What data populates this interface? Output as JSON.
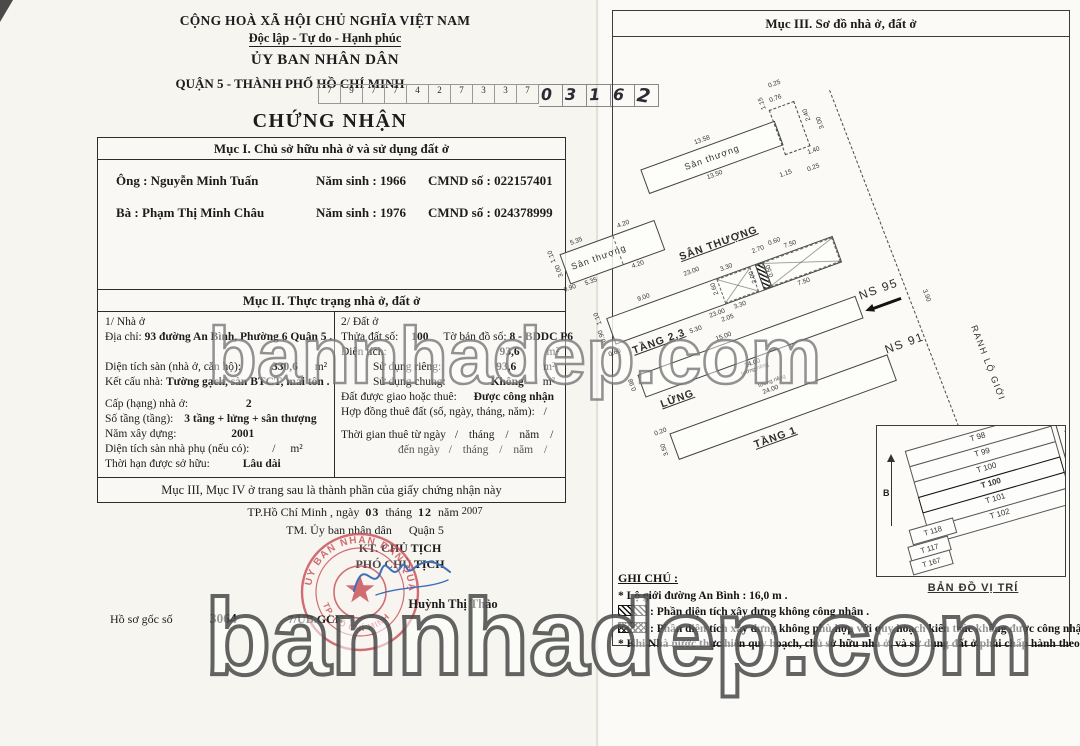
{
  "colors": {
    "seal_red": "#c94f58",
    "signature_blue": "#3f6fb8",
    "paper": "#f6f5f0"
  },
  "watermark": {
    "middle": "bannhadep.com",
    "bottom": "bannhadep.com"
  },
  "left_page": {
    "header": {
      "national_title": "CỘNG HOÀ XÃ HỘI CHỦ NGHĨA VIỆT NAM",
      "motto": "Độc lập - Tự do - Hạnh phúc",
      "issuer": "ỦY BAN NHÂN DÂN",
      "issuer_district": "QUẬN 5 - THÀNH PHỐ HỒ CHÍ MINH",
      "serial_printed": [
        "7",
        "9",
        "7",
        "7",
        "4",
        "2",
        "7",
        "3",
        "3",
        "7"
      ],
      "serial_handwritten": [
        "0",
        "3",
        "1",
        "6",
        "2"
      ],
      "doc_title": "CHỨNG NHẬN"
    },
    "section1": {
      "title": "Mục I. Chủ sở hữu nhà ở và sử dụng đất ở",
      "owner1": {
        "role": "Ông : ",
        "name": "Nguyễn Minh Tuấn",
        "birth_label": "Năm sinh : ",
        "birth": "1966",
        "id_label": "CMND số : ",
        "id": "022157401"
      },
      "owner2": {
        "role": "Bà   : ",
        "name": "Phạm Thị Minh Châu",
        "birth_label": "Năm sinh : ",
        "birth": "1976",
        "id_label": "CMND số : ",
        "id": "024378999"
      }
    },
    "section2": {
      "title": "Mục II. Thực trạng nhà ở, đất ở",
      "house": {
        "heading": "1/ Nhà ở",
        "addr_label": "Địa chỉ:",
        "addr": "93 đường An Bình, Phường 6 Quận 5 .",
        "floor_area_label": "Diện tích sàn (nhà ở, căn hộ):",
        "floor_area": "330,6",
        "unit": "m²",
        "structure_label": "Kết cấu nhà:",
        "structure": "Tường gạch, sàn BTCT, mái tôn .",
        "grade_label": "Cấp (hạng) nhà ở:",
        "grade": "2",
        "storeys_label": "Số tầng (tầng):",
        "storeys": "3 tầng + lửng + sân thượng",
        "year_label": "Năm xây dựng:",
        "year": "2001",
        "aux_label": "Diện tích sàn nhà phụ (nếu có):",
        "aux": "/",
        "aux_unit": "m²",
        "tenure_label": "Thời hạn được sở hữu:",
        "tenure": "Lâu dài"
      },
      "land": {
        "heading": "2/ Đất ở",
        "parcel_label": "Thửa đất số:",
        "parcel": "100",
        "mapsheet_label": "Tờ bản đồ số:",
        "mapsheet": "8 - BDDC P6",
        "area_label": "Diện tích:",
        "area": "93,6",
        "unit": "m²",
        "private_label": "Sử dụng riêng:",
        "private": "93,6",
        "shared_label": "Sử dụng chung:",
        "shared": "Không",
        "granted_label": "Đất được giao hoặc thuê:",
        "granted": "Được công nhận",
        "lease_label": "Hợp đồng thuê đất (số, ngày, tháng, năm):",
        "lease": "/",
        "lease_from": "Thời gian thuê từ ngày",
        "lease_to": "đến ngày",
        "slash": "/",
        "month": "tháng",
        "yearw": "năm"
      },
      "footer": "Mục III, Mục IV ở trang sau là thành phần của giấy chứng nhận này"
    },
    "signing": {
      "place": "TP.Hồ Chí Minh",
      "comma_day": ", ngày",
      "day": "03",
      "month_label": "tháng",
      "month": "12",
      "year_label": "năm",
      "year": "2007",
      "onbehalf": "TM. Ủy ban nhân dân",
      "district": "Quận 5",
      "kt": "KT. CHỦ TỊCH",
      "deputy": "PHÓ CHỦ TỊCH",
      "signer": "Huỳnh Thị Thảo",
      "seal_top": "ỦY BAN NHÂN DÂN QUẬN 5",
      "seal_bottom": "TP. HỒ CHÍ MINH",
      "file_label": "Hồ sơ gốc số",
      "file_no": "3064",
      "file_suffix": "7/UB.GCN"
    }
  },
  "right_page": {
    "title": "Mục III. Sơ đồ nhà ở, đất ở",
    "plan": {
      "terrace_main": {
        "label": "Sân thượng",
        "dim_top": "13.58",
        "dim_bottom": "13.50"
      },
      "annex": {
        "d1": "1.15",
        "d2": "0.76",
        "d3": "2.40",
        "d4": "0.25",
        "d5": "1.40",
        "d6": "3.00",
        "d7": "1.15",
        "d8": "0.25"
      },
      "terrace_small": {
        "label": "Sân thượng",
        "dim_top1": "5.35",
        "dim_top2": "4.20",
        "dim_bottom1": "4.20",
        "dim_bottom2": "5.35",
        "dim_l1": "1.10",
        "dim_l2": "3.00",
        "dim_l3": "0.90"
      },
      "terrace_title": "SÂN THƯỢNG",
      "floor23": {
        "label": "TẦNG 2,3",
        "dim_top": "23.00",
        "dim_bottom": "23.00",
        "dim_seg": "9.00",
        "x1_top": "3.30",
        "x1_left": "2.60",
        "x1_right": "2.00",
        "x1_bottom": "3.30",
        "d_530": "5.30",
        "d_205": "2.05",
        "d_270": "2.70",
        "d_060": "0.60",
        "d_050": "0.50",
        "x2_top": "7.50",
        "x2_bottom": "7.50",
        "dim_l1": "1.10",
        "dim_l2": "0.90",
        "dim_l3": "0.60"
      },
      "mezzanine": {
        "label": "LỬNG",
        "dim_top": "15.00",
        "dim_bottom": "24.00",
        "wall_note": "tường riêng",
        "dim_l1": "0.98"
      },
      "floor1": {
        "label": "TẦNG 1",
        "dim_top": "24.00",
        "wall_note": "tường riêng",
        "dim_l1": "0.20",
        "dim_l2": "3.50"
      },
      "neighbor_top": "NS 95",
      "neighbor_bottom": "NS 91",
      "boundary_label": "RANH LỘ GIỚI",
      "boundary_dim": "3.90"
    },
    "minimap": {
      "parcels": [
        "T 98",
        "T 99",
        "T 100",
        "T 100",
        "T 101",
        "T 102"
      ],
      "parcels_left": [
        "T 118",
        "T 117",
        "T 167"
      ],
      "street": "ĐƯỜNG AN BÌNH",
      "street_width": "16m",
      "direction": "Đi Hàm Tử",
      "north": "B",
      "title": "BẢN ĐỒ VỊ TRÍ"
    },
    "notes": {
      "title": "GHI CHÚ :",
      "item1": "* Lộ giới đường An Bình : 16,0 m .",
      "item2": ": Phần diện tích xây dựng không công nhận .",
      "item3": ": Phần diện tích xây dựng không phù hợp với quy hoạch kiến trúc không được công nhận .",
      "item4": "* Khi Nhà nước thực hiện quy hoạch, chủ sở hữu nhà ở, và sử dụng đất ở phải chấp hành theo quy định."
    }
  }
}
